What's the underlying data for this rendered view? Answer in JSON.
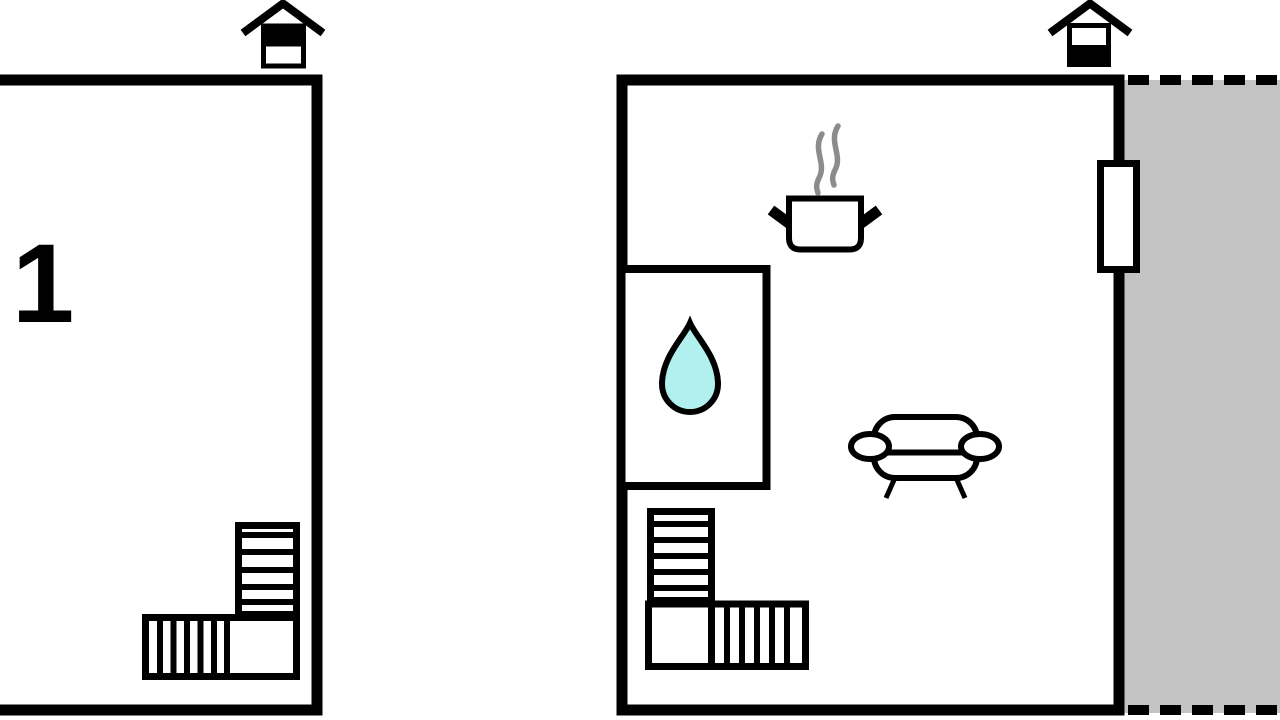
{
  "title": "floor-plan",
  "colors": {
    "wall": "#000000",
    "floor": "#ffffff",
    "terrace": "#c3c3c3",
    "water": "#b2f0f0",
    "steam": "#8c8c8c"
  },
  "plans": {
    "upper": {
      "name": "upper-floor-plan",
      "room_label": "1",
      "level_icon": "house-upper-level-icon",
      "features": [
        "staircase"
      ]
    },
    "ground": {
      "name": "ground-floor-plan",
      "level_icon": "house-ground-level-icon",
      "features": [
        "stove-pot",
        "water-drop-room",
        "sofa",
        "staircase",
        "window",
        "terrace"
      ]
    }
  }
}
